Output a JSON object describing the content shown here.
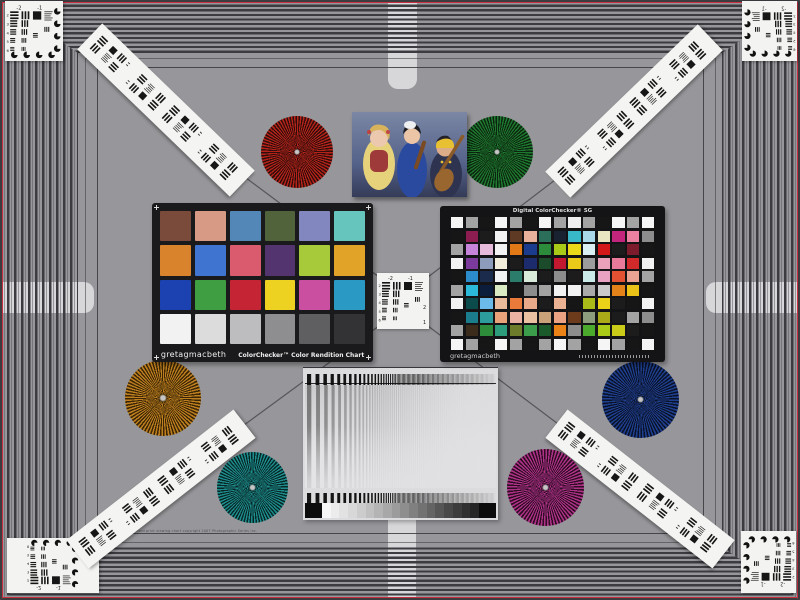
{
  "scene": {
    "background": "#97979b",
    "pinstripe_color": "#c9303f",
    "footer_text": "Standard print viewing chart  copyright 2007 Photographic Series Inc."
  },
  "usaf": {
    "neg2": "-2",
    "neg1": "-1",
    "one": "1",
    "two": "2",
    "row_numbers": [
      "2",
      "3",
      "4",
      "5",
      "6"
    ]
  },
  "colorchecker": {
    "brand": "gretagmacbeth",
    "title": "ColorChecker™ Color Rendition Chart",
    "frame_color": "#1a1a1c",
    "patches": [
      "#7a4b3a",
      "#d69a85",
      "#5287b8",
      "#50633a",
      "#8287c0",
      "#66c5bd",
      "#d9842c",
      "#3f74d0",
      "#da5a6e",
      "#53346e",
      "#a6ca3a",
      "#e2a329",
      "#1c41b0",
      "#3f9e42",
      "#c42433",
      "#edd222",
      "#cb4fa0",
      "#2a9ac4",
      "#f2f2f2",
      "#dcdcdc",
      "#bdbdbf",
      "#8e8e90",
      "#5f5f61",
      "#333335"
    ]
  },
  "sg": {
    "brand": "gretagmacbeth",
    "title": "Digital ColorChecker® SG",
    "frame_color": "#141416",
    "rows": [
      [
        "#f5f5f5",
        "#a3a3a3",
        "#161616",
        "#f5f5f5",
        "#a3a3a3",
        "#161616",
        "#f5f5f5",
        "#a3a3a3",
        "#f0f0f0",
        "#a3a3a3",
        "#161616",
        "#f5f5f5",
        "#a3a3a3",
        "#f5f5f5"
      ],
      [
        "#161616",
        "#8d1d50",
        "#1c1c1c",
        "#f2f2f2",
        "#5e3a24",
        "#eab29b",
        "#2b6e59",
        "#182230",
        "#38b7c9",
        "#a9d9e9",
        "#eae6c2",
        "#c1267c",
        "#ea81a1",
        "#8d8d8d"
      ],
      [
        "#a3a3a3",
        "#c685da",
        "#e6bada",
        "#f2f2f2",
        "#e27916",
        "#1b3b8c",
        "#2c8c3c",
        "#aaca18",
        "#ead918",
        "#daeff1",
        "#d21818",
        "#1c1c1c",
        "#7c1b2b",
        "#161616"
      ],
      [
        "#f2f2f2",
        "#7c3b9c",
        "#8c9cba",
        "#f2ecda",
        "#1c1c1c",
        "#1b2b6c",
        "#1b4b2b",
        "#c21830",
        "#eaca18",
        "#9c9c9c",
        "#eaa2ba",
        "#ea7a9a",
        "#d22a2a",
        "#f2f2f2"
      ],
      [
        "#161616",
        "#2c8cca",
        "#1b2b4b",
        "#f2f2f2",
        "#2c7c6c",
        "#daeada",
        "#1c1c1c",
        "#8c8c8c",
        "#1c1c1c",
        "#caeaea",
        "#eaa2c2",
        "#e25232",
        "#eaa292",
        "#a3a3a3"
      ],
      [
        "#a3a3a3",
        "#2cbada",
        "#0c1c3b",
        "#daeac2",
        "#161616",
        "#8c8c8c",
        "#a3a3a3",
        "#f2f2f2",
        "#f2f2f2",
        "#aaaaaa",
        "#cacaca",
        "#e28218",
        "#eac218",
        "#161616"
      ],
      [
        "#f2f2f2",
        "#0c4b4b",
        "#6cbaea",
        "#eaba9a",
        "#ea7a3a",
        "#eaaa8a",
        "#1c1c1c",
        "#eab292",
        "#161616",
        "#aaba18",
        "#ead218",
        "#1c1c1c",
        "#161616",
        "#f2f2f2"
      ],
      [
        "#161616",
        "#1b7c8c",
        "#2c9c9c",
        "#eaa27a",
        "#eab2a2",
        "#eac2a2",
        "#caa27a",
        "#eaa282",
        "#6c3b1b",
        "#8c9c7c",
        "#aaaa18",
        "#1c1c1c",
        "#a3a3a3",
        "#8d8d8d"
      ],
      [
        "#a3a3a3",
        "#3b2b1b",
        "#2c8c3c",
        "#2c9c7c",
        "#6c7c2b",
        "#3b9c4b",
        "#1b5b2b",
        "#ea8218",
        "#8c8c8c",
        "#4baa2c",
        "#aaca18",
        "#caca18",
        "#1c1c1c",
        "#161616"
      ],
      [
        "#f5f5f5",
        "#a3a3a3",
        "#161616",
        "#f5f5f5",
        "#a3a3a3",
        "#161616",
        "#a3a3a3",
        "#f5f5f5",
        "#a3a3a3",
        "#161616",
        "#f5f5f5",
        "#a3a3a3",
        "#161616",
        "#f5f5f5"
      ]
    ]
  },
  "stars": [
    {
      "name": "red-siemens-star",
      "color": "#b5231a",
      "dark": "#2e0d0a",
      "left": 261,
      "top": 116,
      "size": 72
    },
    {
      "name": "green-siemens-star",
      "color": "#1e7a2e",
      "dark": "#0c2410",
      "left": 461,
      "top": 116,
      "size": 72
    },
    {
      "name": "orange-siemens-star",
      "color": "#bf7f1e",
      "dark": "#3a2606",
      "left": 125,
      "top": 360,
      "size": 76
    },
    {
      "name": "blue-siemens-star",
      "color": "#1e3e8e",
      "dark": "#0a1228",
      "left": 602,
      "top": 361,
      "size": 77
    },
    {
      "name": "teal-siemens-star",
      "color": "#1e8c8c",
      "dark": "#082828",
      "left": 217,
      "top": 452,
      "size": 71
    },
    {
      "name": "magenta-siemens-star",
      "color": "#ad3286",
      "dark": "#2e0c24",
      "left": 507,
      "top": 449,
      "size": 77
    }
  ],
  "sweep_panel": {
    "gray_steps": [
      "#f6f6f6",
      "#ececec",
      "#e2e2e2",
      "#d8d8d8",
      "#cccccc",
      "#c0c0c0",
      "#b4b4b4",
      "#a8a8a8",
      "#9c9c9c",
      "#8e8e8e",
      "#808080",
      "#727272",
      "#646464",
      "#565656",
      "#484848",
      "#3c3c3c",
      "#303030",
      "#262626"
    ]
  }
}
